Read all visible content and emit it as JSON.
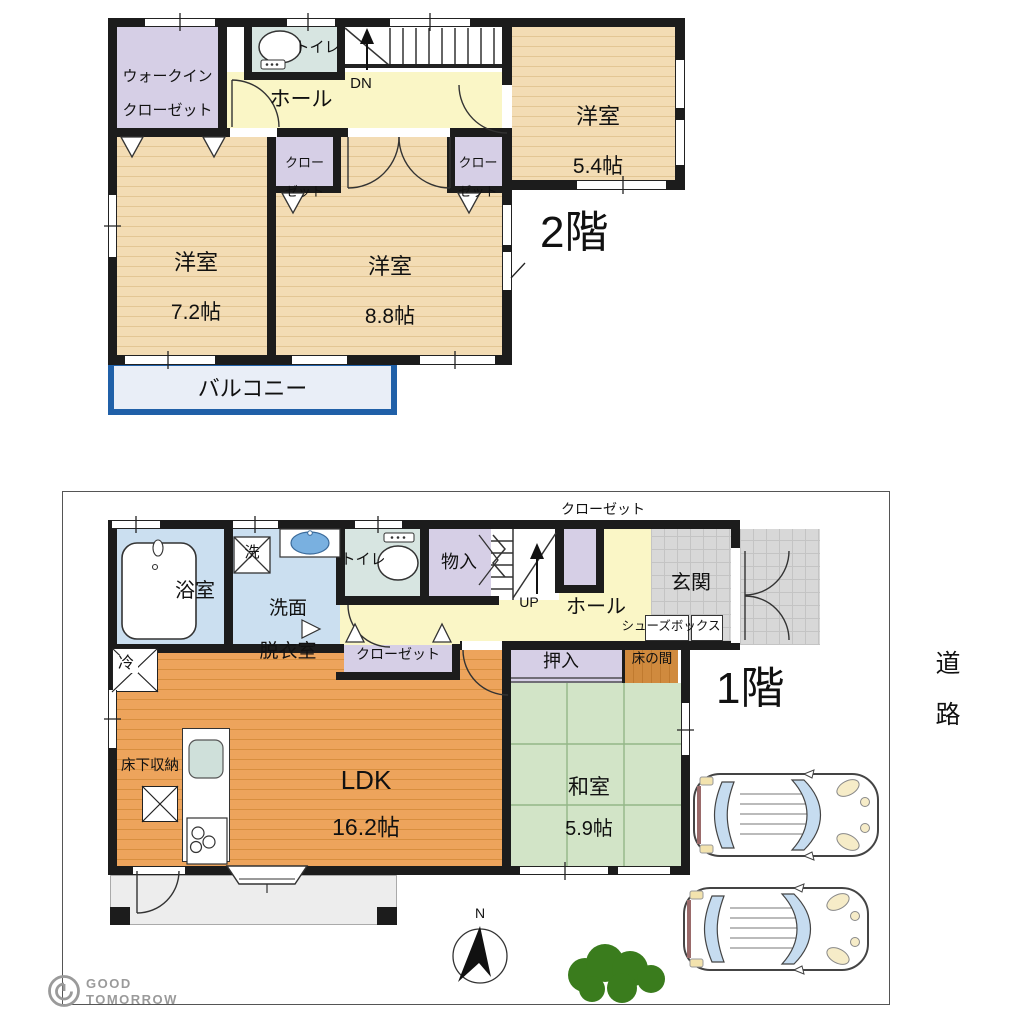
{
  "f2": {
    "label": "2階",
    "wic1": "ウォークイン",
    "wic2": "クローゼット",
    "toilet": "トイレ",
    "dn": "DN",
    "hall": "ホール",
    "cl1a": "クロー",
    "cl1b": "ゼット",
    "cl2a": "クロー",
    "cl2b": "ゼット",
    "r54n": "洋室",
    "r54s": "5.4帖",
    "r72n": "洋室",
    "r72s": "7.2帖",
    "r88n": "洋室",
    "r88s": "8.8帖",
    "balcony": "バルコニー"
  },
  "f1": {
    "label": "1階",
    "closet_top": "クローゼット",
    "bath": "浴室",
    "washer": "洗",
    "wash1": "洗面",
    "wash2": "脱衣室",
    "toilet": "トイレ",
    "monoire": "物入",
    "up": "UP",
    "hall": "ホール",
    "genkan": "玄関",
    "shoebox": "シューズボックス",
    "closet": "クローゼット",
    "fridge": "冷",
    "ldk": "LDK",
    "ldk_size": "16.2帖",
    "underfloor": "床下収納",
    "oshiire": "押入",
    "tokonoma": "床の間",
    "washitsu": "和室",
    "washitsu_size": "5.9帖"
  },
  "site": {
    "road": "道路",
    "north": "N"
  },
  "logo": {
    "l1": "GOOD",
    "l2": "TOMORROW"
  },
  "colors": {
    "wall": "#1c1c1c",
    "wood": "#f3dcb4",
    "wood_line": "#e3c694",
    "ldk": "#eda45c",
    "ldk_line": "#d88f3f",
    "tatami": "#d2e4c7",
    "tatami_line": "#93b787",
    "purple": "#d6cfe6",
    "blue": "#cbdff0",
    "cyan": "#d7e5e1",
    "yellow": "#faf6c6",
    "gray_tile": "#d8d8d8",
    "gray_tile_line": "#c4c4c4",
    "balcony_fill": "#e9eef7",
    "balcony_border": "#2060a8",
    "tokonoma": "#d08a3e",
    "terrace": "#ededed",
    "bush_green": "#3a7c1d",
    "car_glass": "#c6dcf0",
    "logo_gray": "#9a9a9a"
  }
}
